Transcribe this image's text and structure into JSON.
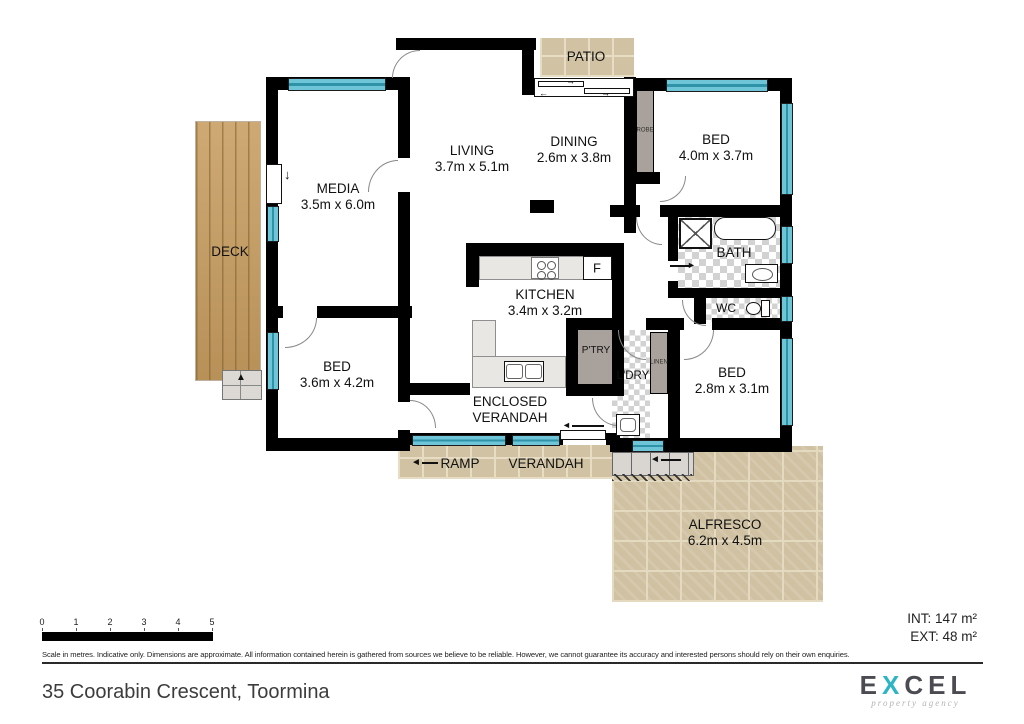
{
  "plan": {
    "rooms": {
      "patio": {
        "name": "PATIO"
      },
      "living": {
        "name": "LIVING",
        "dims": "3.7m x 5.1m"
      },
      "dining": {
        "name": "DINING",
        "dims": "2.6m x 3.8m"
      },
      "bed1": {
        "name": "BED",
        "dims": "4.0m x 3.7m"
      },
      "media": {
        "name": "MEDIA",
        "dims": "3.5m x 6.0m"
      },
      "deck": {
        "name": "DECK"
      },
      "bath": {
        "name": "BATH"
      },
      "wc": {
        "name": "WC"
      },
      "kitchen": {
        "name": "KITCHEN",
        "dims": "3.4m x 3.2m"
      },
      "fridge": {
        "label": "F"
      },
      "pantry": {
        "name": "P'TRY"
      },
      "laundry": {
        "name": "L'DRY"
      },
      "linen": {
        "name": "LINEN"
      },
      "robe": {
        "name": "ROBE"
      },
      "bed2": {
        "name": "BED",
        "dims": "3.6m x 4.2m"
      },
      "bed3": {
        "name": "BED",
        "dims": "2.8m x 3.1m"
      },
      "enclosed_verandah": {
        "line1": "ENCLOSED",
        "line2": "VERANDAH"
      },
      "ramp": {
        "name": "RAMP"
      },
      "verandah": {
        "name": "VERANDAH"
      },
      "alfresco": {
        "name": "ALFRESCO",
        "dims": "6.2m x 4.5m"
      }
    },
    "icons": {
      "arrow_up": "▲",
      "arrow_down": "↓",
      "arrow_left_solid": "◄",
      "arrow_right_solid": "►",
      "arrow_left": "←",
      "arrow_right": "→"
    }
  },
  "scale_bar": {
    "ticks": [
      "0",
      "1",
      "2",
      "3",
      "4",
      "5"
    ]
  },
  "areas": {
    "int": "INT: 147 m²",
    "ext": "EXT: 48 m²"
  },
  "disclaimer": "Scale in metres. Indicative only. Dimensions are approximate. All information contained herein is gathered from sources we believe to be reliable. However, we cannot guarantee its accuracy and interested persons should rely on their own enquiries.",
  "address": "35 Coorabin Crescent, Toormina",
  "logo": {
    "pre": "E",
    "x": "X",
    "post": "CEL",
    "tagline": "property agency"
  },
  "colors": {
    "wall": "#000000",
    "window": "#6fc5d8",
    "closet": "#a9a19b",
    "wood": "#c79d60",
    "stone": "#d0c2a2",
    "logo_teal": "#2eb4c4",
    "logo_gray": "#4b4b52"
  }
}
